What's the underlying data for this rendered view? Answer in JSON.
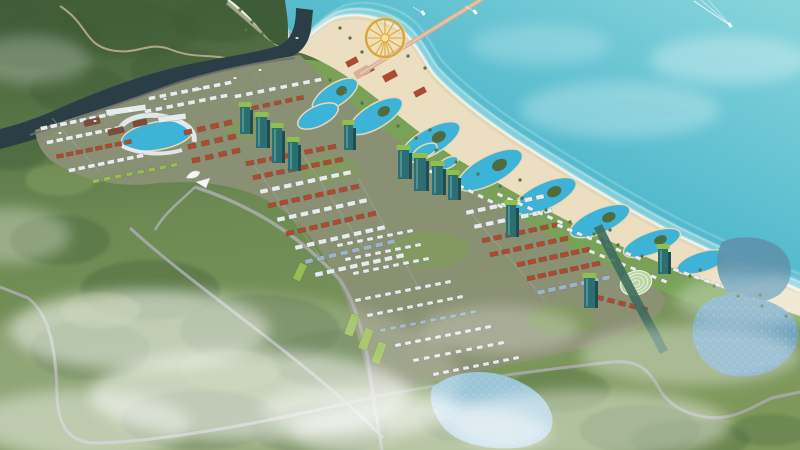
{
  "meta": {
    "title": "Aerial rendering — coastal resort master plan",
    "description": "Bird's-eye architectural rendering of a seaside resort development: turquoise ocean with pier and golden ferris wheel, sandy beach, lagoon pools, rows of townhouses and villas, high-rise towers, forested hills, lakes, winding roads and drifting mist."
  },
  "palette": {
    "oceanDeep": "#2f9fbd",
    "ocean": "#4bb6cb",
    "oceanLight": "#8ad5dc",
    "foam": "#ffffff",
    "shallow": "#bfe9ea",
    "sand": "#ecdfc1",
    "sandWet": "#dccfae",
    "coastGreen": "#79a258",
    "lawn": "#7f9e57",
    "hill": "#56774a",
    "hillDark": "#3f5c38",
    "forest": "#6d8a54",
    "forestDark": "#4f6c40",
    "forestLight": "#90a768",
    "river": "#2b3d45",
    "channel": "#3f6b5d",
    "pool": "#3db3d8",
    "poolRim": "#ead9b4",
    "lake": "#6fa2bc",
    "lakeUpper": "#5d93ad",
    "lakeLight": "#9cc6d8",
    "road": "#a3a8a2",
    "roadDark": "#6b726e",
    "dirt": "#c9ba94",
    "street": "#a6aba4",
    "devGround": "#8b9175",
    "roofRed": "#ae4a30",
    "roofWhite": "#e6ebee",
    "roofBlue": "#9db4c2",
    "roofGreen": "#97bb55",
    "slab": "#7e4a3c",
    "towerTeal": "#2d6e72",
    "towerSide": "#1f4e52",
    "towerGlass": "#58a3a0",
    "towerRoof": "#8fbf4f",
    "gold": "#dca43c",
    "goldLight": "#f7e39b",
    "pier": "#d7b197",
    "pierDeck": "#e8cbb2",
    "domeGreen": "#b9d6a2",
    "domeRib": "#f2f6ee",
    "gate": "#f4f6f6",
    "boat": "#ffffff",
    "mist": "#ffffff"
  },
  "scene": {
    "wheel": {
      "cx": 385,
      "cy": 38,
      "r": 19,
      "spokes": 12
    },
    "house_rows": [
      [
        44,
        128,
        112,
        114,
        8,
        7,
        4,
        "roofWhite"
      ],
      [
        50,
        142,
        118,
        128,
        8,
        7,
        4,
        "roofWhite"
      ],
      [
        60,
        156,
        128,
        142,
        8,
        7,
        4,
        "roofRed"
      ],
      [
        72,
        170,
        140,
        156,
        8,
        7,
        4,
        "roofWhite"
      ],
      [
        96,
        181,
        174,
        165,
        8,
        7,
        4,
        "roofGreen"
      ],
      [
        152,
        98,
        228,
        83,
        8,
        7,
        4,
        "roofWhite"
      ],
      [
        148,
        111,
        224,
        96,
        8,
        7,
        4,
        "roofWhite"
      ],
      [
        188,
        132,
        228,
        123,
        4,
        8,
        5,
        "roofRed"
      ],
      [
        192,
        146,
        232,
        137,
        4,
        8,
        5,
        "roofRed"
      ],
      [
        196,
        160,
        236,
        151,
        4,
        8,
        5,
        "roofRed"
      ],
      [
        250,
        163,
        332,
        147,
        8,
        8,
        4.5,
        "roofRed"
      ],
      [
        257,
        177,
        339,
        160,
        8,
        8,
        4.5,
        "roofRed"
      ],
      [
        264,
        191,
        347,
        173,
        8,
        8,
        4.5,
        "roofWhite"
      ],
      [
        272,
        205,
        355,
        187,
        8,
        8,
        4.5,
        "roofRed"
      ],
      [
        281,
        219,
        363,
        201,
        8,
        8,
        4.5,
        "roofWhite"
      ],
      [
        290,
        233,
        372,
        214,
        8,
        8,
        4.5,
        "roofRed"
      ],
      [
        299,
        247,
        381,
        228,
        8,
        8,
        4.5,
        "roofWhite"
      ],
      [
        309,
        261,
        391,
        242,
        8,
        8,
        4.5,
        "roofBlue"
      ],
      [
        319,
        274,
        400,
        256,
        8,
        8,
        4.5,
        "roofWhite"
      ],
      [
        238,
        96,
        318,
        80,
        8,
        7,
        4,
        "roofWhite"
      ],
      [
        244,
        110,
        300,
        98,
        6,
        7,
        4,
        "roofRed"
      ],
      [
        470,
        212,
        540,
        197,
        7,
        8,
        4.5,
        "roofWhite"
      ],
      [
        478,
        226,
        548,
        211,
        7,
        8,
        4.5,
        "roofWhite"
      ],
      [
        486,
        240,
        556,
        225,
        7,
        8,
        4.5,
        "roofRed"
      ],
      [
        494,
        254,
        564,
        239,
        7,
        8,
        4.5,
        "roofRed"
      ],
      [
        521,
        264,
        586,
        250,
        7,
        8,
        4.5,
        "roofRed"
      ],
      [
        531,
        278,
        596,
        264,
        7,
        8,
        4.5,
        "roofRed"
      ],
      [
        541,
        292,
        606,
        278,
        7,
        8,
        4.5,
        "roofBlue"
      ],
      [
        600,
        298,
        644,
        309,
        5,
        7,
        4.5,
        "roofRed"
      ],
      [
        358,
        300,
        448,
        282,
        10,
        6,
        3.5,
        "roofWhite"
      ],
      [
        370,
        315,
        460,
        297,
        10,
        6,
        3.5,
        "roofWhite"
      ],
      [
        383,
        330,
        473,
        312,
        10,
        6,
        3.5,
        "roofBlue"
      ],
      [
        398,
        345,
        488,
        327,
        10,
        6,
        3.5,
        "roofWhite"
      ],
      [
        416,
        360,
        501,
        343,
        9,
        6,
        3.5,
        "roofWhite"
      ],
      [
        436,
        374,
        516,
        358,
        9,
        6,
        3.5,
        "roofWhite"
      ],
      [
        340,
        245,
        410,
        231,
        8,
        6,
        3.5,
        "roofWhite"
      ],
      [
        348,
        259,
        418,
        245,
        8,
        6,
        3.5,
        "roofWhite"
      ],
      [
        356,
        273,
        426,
        259,
        8,
        6,
        3.5,
        "roofWhite"
      ],
      [
        432,
        172,
        500,
        206,
        8,
        6,
        3.5,
        "roofWhite"
      ],
      [
        500,
        195,
        560,
        222,
        7,
        6,
        3.5,
        "roofWhite"
      ],
      [
        560,
        226,
        638,
        258,
        9,
        6,
        3.5,
        "roofWhite"
      ],
      [
        592,
        252,
        664,
        281,
        8,
        6,
        3.5,
        "roofWhite"
      ],
      [
        676,
        270,
        738,
        292,
        7,
        6,
        3.5,
        "roofWhite"
      ]
    ],
    "blocks": [
      [
        92,
        122,
        16,
        6,
        -13,
        "slab"
      ],
      [
        116,
        131,
        16,
        6,
        -13,
        "slab"
      ],
      [
        140,
        123,
        14,
        6,
        -13,
        "slab"
      ],
      [
        126,
        110,
        40,
        6,
        -8,
        "roofWhite"
      ],
      [
        172,
        118,
        28,
        6,
        -8,
        "roofWhite"
      ],
      [
        352,
        325,
        9,
        22,
        20,
        "roofGreen"
      ],
      [
        366,
        339,
        9,
        22,
        20,
        "roofGreen"
      ],
      [
        379,
        353,
        9,
        22,
        20,
        "roofGreen"
      ],
      [
        300,
        272,
        8,
        18,
        25,
        "roofGreen"
      ],
      [
        352,
        62,
        12,
        6,
        -28,
        "roofRed"
      ],
      [
        368,
        70,
        12,
        6,
        -28,
        "roofRed"
      ],
      [
        390,
        76,
        14,
        7,
        -28,
        "roofRed"
      ],
      [
        420,
        92,
        12,
        6,
        -28,
        "roofRed"
      ]
    ],
    "towers": [
      [
        240,
        106,
        10,
        28
      ],
      [
        256,
        116,
        11,
        32
      ],
      [
        272,
        127,
        10,
        36
      ],
      [
        288,
        141,
        10,
        30
      ],
      [
        344,
        124,
        9,
        26
      ],
      [
        398,
        149,
        11,
        30
      ],
      [
        414,
        157,
        12,
        34
      ],
      [
        432,
        165,
        11,
        30
      ],
      [
        448,
        174,
        10,
        26
      ],
      [
        506,
        204,
        10,
        33
      ],
      [
        584,
        277,
        11,
        31
      ],
      [
        658,
        248,
        10,
        26
      ]
    ],
    "lagoons": [
      [
        335,
        95,
        26,
        11,
        -33,
        1
      ],
      [
        376,
        116,
        30,
        12,
        -31,
        1
      ],
      [
        430,
        142,
        34,
        13,
        -30,
        1
      ],
      [
        490,
        170,
        36,
        14,
        -28,
        1
      ],
      [
        545,
        196,
        34,
        13,
        -25,
        1
      ],
      [
        600,
        221,
        32,
        12,
        -23,
        1
      ],
      [
        652,
        243,
        30,
        11,
        -20,
        1
      ],
      [
        702,
        262,
        26,
        10,
        -17,
        0
      ],
      [
        748,
        278,
        22,
        9,
        -14,
        0
      ],
      [
        157,
        136,
        36,
        14,
        -10,
        0
      ],
      [
        318,
        116,
        22,
        10,
        -26,
        0
      ],
      [
        425,
        151,
        13,
        6,
        -26,
        0
      ],
      [
        448,
        163,
        11,
        5,
        -26,
        0
      ]
    ],
    "palms": [
      [
        330,
        80
      ],
      [
        345,
        92
      ],
      [
        362,
        103
      ],
      [
        380,
        114
      ],
      [
        398,
        126
      ],
      [
        416,
        138
      ],
      [
        436,
        150
      ],
      [
        456,
        162
      ],
      [
        478,
        174
      ],
      [
        500,
        186
      ],
      [
        522,
        198
      ],
      [
        546,
        210
      ],
      [
        570,
        222
      ],
      [
        594,
        234
      ],
      [
        618,
        245
      ],
      [
        642,
        256
      ],
      [
        666,
        266
      ],
      [
        690,
        276
      ],
      [
        714,
        286
      ],
      [
        738,
        296
      ],
      [
        762,
        306
      ],
      [
        786,
        316
      ],
      [
        430,
        130
      ],
      [
        520,
        180
      ],
      [
        610,
        230
      ],
      [
        700,
        270
      ],
      [
        760,
        295
      ],
      [
        350,
        38
      ],
      [
        362,
        52
      ],
      [
        408,
        56
      ],
      [
        425,
        68
      ],
      [
        340,
        28
      ],
      [
        240,
        10
      ],
      [
        252,
        22
      ],
      [
        262,
        34
      ],
      [
        272,
        42
      ],
      [
        246,
        30
      ]
    ],
    "boats_sea": [
      [
        423,
        13,
        0
      ],
      [
        475,
        12,
        0
      ],
      [
        730,
        25,
        1
      ]
    ],
    "boats_river": [
      [
        60,
        133
      ],
      [
        95,
        121
      ],
      [
        130,
        110
      ],
      [
        165,
        99
      ],
      [
        200,
        89
      ],
      [
        235,
        78
      ],
      [
        260,
        70
      ],
      [
        297,
        38
      ]
    ],
    "mist": [
      [
        140,
        330,
        130,
        40,
        0.45
      ],
      [
        250,
        395,
        160,
        45,
        0.5
      ],
      [
        80,
        425,
        110,
        35,
        0.4
      ],
      [
        420,
        432,
        130,
        30,
        0.45
      ],
      [
        590,
        425,
        140,
        35,
        0.4
      ],
      [
        690,
        355,
        110,
        30,
        0.35
      ],
      [
        755,
        300,
        80,
        26,
        0.3
      ],
      [
        30,
        60,
        60,
        24,
        0.25
      ],
      [
        10,
        235,
        60,
        28,
        0.3
      ],
      [
        500,
        330,
        80,
        24,
        0.25
      ],
      [
        620,
        110,
        100,
        28,
        0.15
      ],
      [
        730,
        60,
        80,
        24,
        0.18
      ],
      [
        540,
        45,
        70,
        20,
        0.12
      ],
      [
        360,
        410,
        100,
        26,
        0.4
      ],
      [
        200,
        380,
        260,
        90,
        0.18
      ]
    ],
    "forest_blobs": [
      [
        60,
        240,
        50,
        25,
        "forestDark",
        0.5
      ],
      [
        150,
        290,
        70,
        30,
        "forestDark",
        0.5
      ],
      [
        260,
        330,
        80,
        35,
        "forestDark",
        0.45
      ],
      [
        340,
        360,
        70,
        30,
        "forestDark",
        0.45
      ],
      [
        90,
        350,
        60,
        30,
        "forestDark",
        0.4
      ],
      [
        200,
        420,
        80,
        30,
        "forestDark",
        0.45
      ],
      [
        320,
        430,
        70,
        25,
        "forestDark",
        0.4
      ],
      [
        480,
        420,
        60,
        25,
        "forestDark",
        0.35
      ],
      [
        560,
        390,
        50,
        22,
        "forestDark",
        0.35
      ],
      [
        640,
        430,
        60,
        25,
        "forestDark",
        0.4
      ],
      [
        690,
        440,
        60,
        20,
        "forestDark",
        0.4
      ],
      [
        770,
        430,
        40,
        16,
        "forestDark",
        0.35
      ],
      [
        40,
        40,
        60,
        30,
        "hillDark",
        0.55
      ],
      [
        130,
        30,
        70,
        28,
        "hillDark",
        0.5
      ],
      [
        220,
        20,
        50,
        22,
        "hillDark",
        0.5
      ],
      [
        80,
        90,
        50,
        24,
        "hillDark",
        0.45
      ],
      [
        180,
        70,
        50,
        22,
        "hillDark",
        0.45
      ],
      [
        10,
        150,
        40,
        20,
        "hillDark",
        0.4
      ],
      [
        100,
        310,
        40,
        18,
        "forestLight",
        0.5
      ],
      [
        230,
        370,
        50,
        20,
        "forestLight",
        0.45
      ],
      [
        420,
        400,
        40,
        16,
        "forestLight",
        0.4
      ],
      [
        60,
        180,
        35,
        16,
        "forestLight",
        0.4
      ]
    ],
    "lawns": [
      [
        430,
        250,
        40,
        18
      ],
      [
        330,
        170,
        30,
        14
      ],
      [
        560,
        320,
        35,
        15
      ],
      [
        250,
        130,
        25,
        10
      ]
    ]
  }
}
